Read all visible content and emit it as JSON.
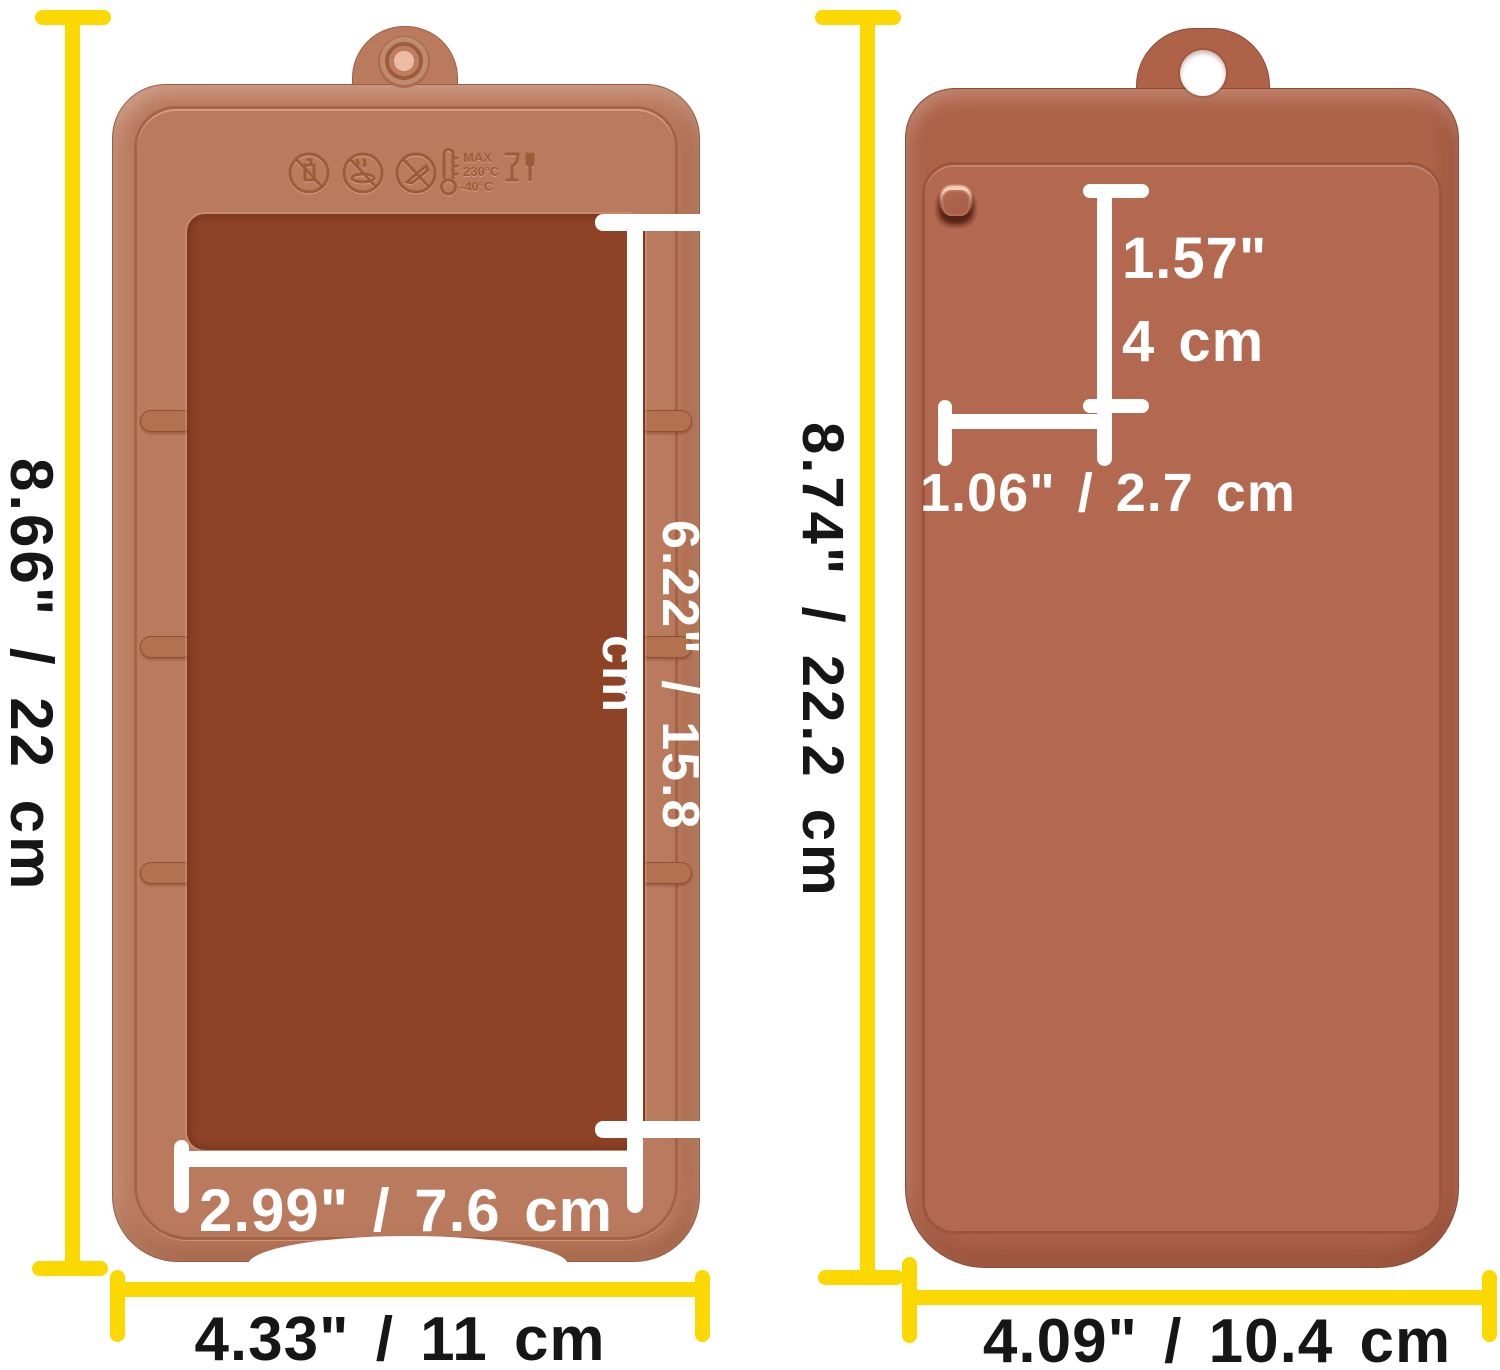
{
  "colors": {
    "dim_line_yellow": "#fbd800",
    "dim_line_white": "#ffffff",
    "label_black": "#161616",
    "mold1_frame": "#ba7a5d",
    "mold1_cavity": "#8f4326",
    "mold1_cell": "#9c4b2b",
    "mold1_grommet_center": "#edbca4",
    "mold2_body": "#ae6349",
    "mold2_recess": "#b26950",
    "mold2_bar": "#a95c44"
  },
  "left_mold": {
    "grid": {
      "cols": 4,
      "rows": 6
    },
    "emboss": {
      "line1": "MAX",
      "line2": "230°C",
      "line3": "-40°C"
    },
    "dims": {
      "height": "8.66\" / 22 cm",
      "cavity_height": "6.22\" / 15.8 cm",
      "cavity_width": "2.99\" / 7.6 cm",
      "width": "4.33\" / 11 cm"
    }
  },
  "right_mold": {
    "grid": {
      "cols": 3,
      "rows": 4
    },
    "mini_bar_grid": {
      "cols": 3,
      "rows": 4
    },
    "dims": {
      "height": "8.74\" / 22.2 cm",
      "cavity_height_in": "1.57\"",
      "cavity_height_cm": "4 cm",
      "cavity_width": "1.06\" / 2.7 cm",
      "width": "4.09\" / 10.4 cm"
    }
  }
}
